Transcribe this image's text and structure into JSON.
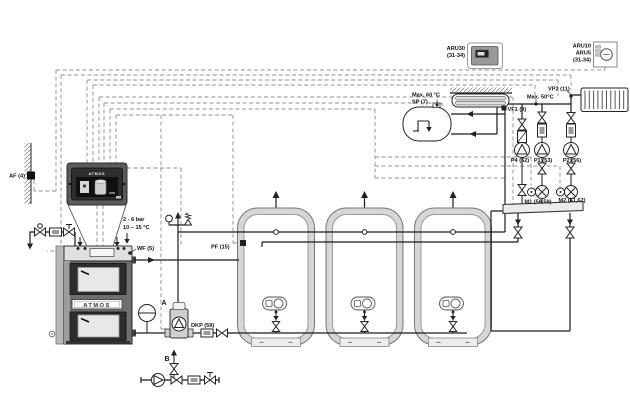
{
  "meta": {
    "type": "hydraulic-schematic",
    "brand": "ATMOS"
  },
  "labels": {
    "outdoor_sensor": "AF (4)",
    "boiler_sensor": "WF (5)",
    "dhw_sensor": "SP (7)",
    "flow_sensor_1": "VF1 (9)",
    "flow_sensor_2": "VP2 (11)",
    "buffer_sensor": "PF (15)",
    "pump_4": "P4 (62)",
    "pump_1": "P1 (53)",
    "pump_2": "P2 (56)",
    "mixer_1": "M1 (58,59)",
    "mixer_2": "M2 (61,62)",
    "boiler_pump": "DKP (59)",
    "max_60": "Max. 60 °C",
    "max_50": "Max. 50°C",
    "pressure_range": "2 - 6 bar",
    "temp_range": "10 – 15 °C",
    "point_a": "A",
    "point_b": "B"
  },
  "room_units": {
    "aru30": {
      "name": "ARU30",
      "terminals": "(31-34)"
    },
    "aru10": {
      "name": "ARU10",
      "alt": "ARU5",
      "terminals": "(31-34)"
    }
  },
  "controller": {
    "brand": "ATMOS"
  },
  "boiler": {
    "brand": "ATMOS"
  },
  "icons": {
    "pump": "pump-icon",
    "valve": "valve-icon",
    "mixing_valve": "mixing-valve-icon",
    "filter": "filter-icon",
    "safety_valve": "safety-valve-icon",
    "expansion_vessel": "expansion-vessel-icon",
    "radiator": "radiator-icon",
    "heat_exchanger": "heat-exchanger-icon",
    "buffer_tank": "buffer-tank-icon"
  },
  "colors": {
    "pipe": "#1a1a1a",
    "cable": "#8f8f8f",
    "boiler_door": "#2d2d2d",
    "panel": "#2e2e2e",
    "insulation": "#d6d6d6"
  }
}
